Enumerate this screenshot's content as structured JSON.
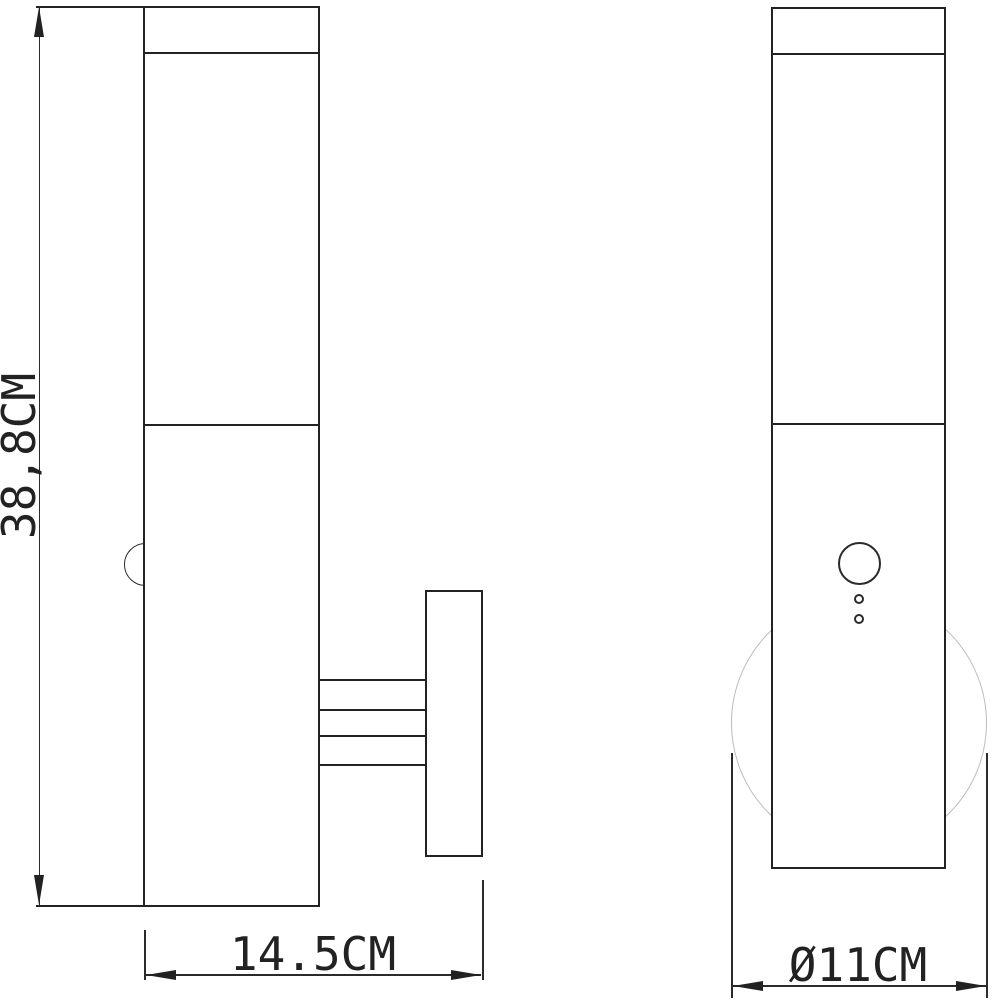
{
  "drawing": {
    "dimensions": {
      "height_label": "38,8CM",
      "width_label": "14.5CM",
      "diameter_label": "Ø11CM"
    },
    "colors": {
      "line": "#222222",
      "thin_line": "#2b2b2b",
      "ghost_circle": "#bdbdbd",
      "background": "#ffffff"
    }
  }
}
